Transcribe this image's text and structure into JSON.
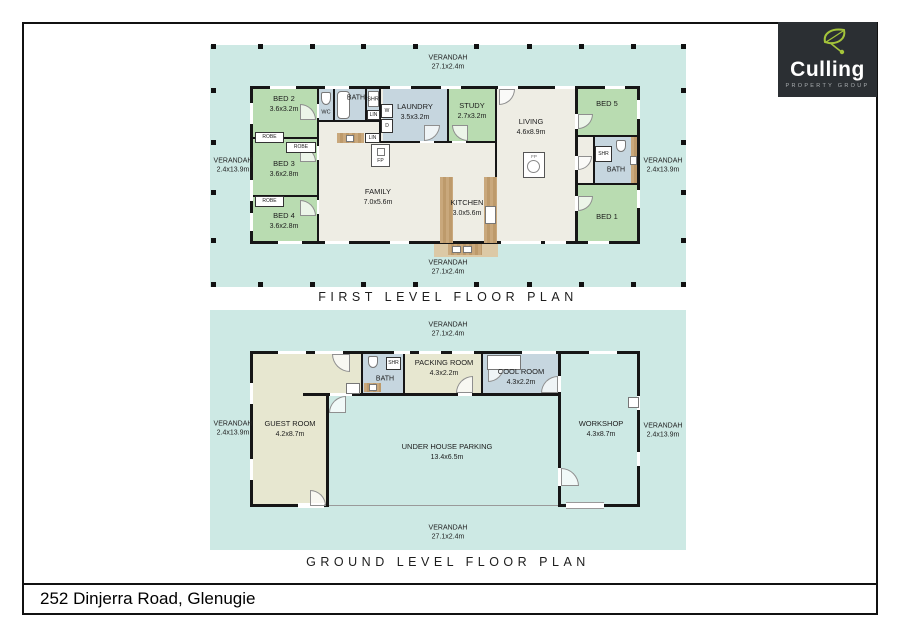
{
  "address_bar": {
    "address": "252 Dinjerra Road, Glenugie"
  },
  "logo": {
    "brand": "Culling",
    "tagline": "PROPERTY GROUP",
    "bg_color": "#2b2f33",
    "leaf_color": "#a4c43a"
  },
  "labels": {
    "verandah": "VERANDAH",
    "long_dim": "27.1x2.4m",
    "side_dim": "2.4x13.9m",
    "robe": "ROBE",
    "lin": "LIN",
    "shr": "SHR",
    "wc": "WC",
    "bath": "BATH",
    "w": "W",
    "d": "D",
    "fp": "FP"
  },
  "first_level": {
    "title": "FIRST LEVEL FLOOR PLAN",
    "rooms": {
      "bed2": {
        "name": "BED 2",
        "dim": "3.6x3.2m"
      },
      "bed3": {
        "name": "BED 3",
        "dim": "3.6x2.8m"
      },
      "bed4": {
        "name": "BED 4",
        "dim": "3.6x2.8m"
      },
      "laundry": {
        "name": "LAUNDRY",
        "dim": "3.5x3.2m"
      },
      "study": {
        "name": "STUDY",
        "dim": "2.7x3.2m"
      },
      "living": {
        "name": "LIVING",
        "dim": "4.6x8.9m"
      },
      "family": {
        "name": "FAMILY",
        "dim": "7.0x5.6m"
      },
      "kitchen": {
        "name": "KITCHEN",
        "dim": "3.0x5.6m"
      },
      "bed5": {
        "name": "BED 5"
      },
      "bed1": {
        "name": "BED 1"
      }
    }
  },
  "ground_level": {
    "title": "GROUND LEVEL FLOOR PLAN",
    "rooms": {
      "guest": {
        "name": "GUEST ROOM",
        "dim": "4.2x8.7m"
      },
      "packing": {
        "name": "PACKING ROOM",
        "dim": "4.3x2.2m"
      },
      "cool": {
        "name": "COOL ROOM",
        "dim": "4.3x2.2m"
      },
      "workshop": {
        "name": "WORKSHOP",
        "dim": "4.3x8.7m"
      },
      "parking": {
        "name": "UNDER HOUSE PARKING",
        "dim": "13.4x6.5m"
      }
    }
  },
  "colors": {
    "verandah_teal": "#cde9e4",
    "bedroom_green": "#b9dcb1",
    "wet_area_blue": "#c6d6df",
    "interior_cream": "#eeede4",
    "guest_olive": "#e7e7d0",
    "bench_wood": "#c9a87c",
    "wall": "#161616"
  }
}
